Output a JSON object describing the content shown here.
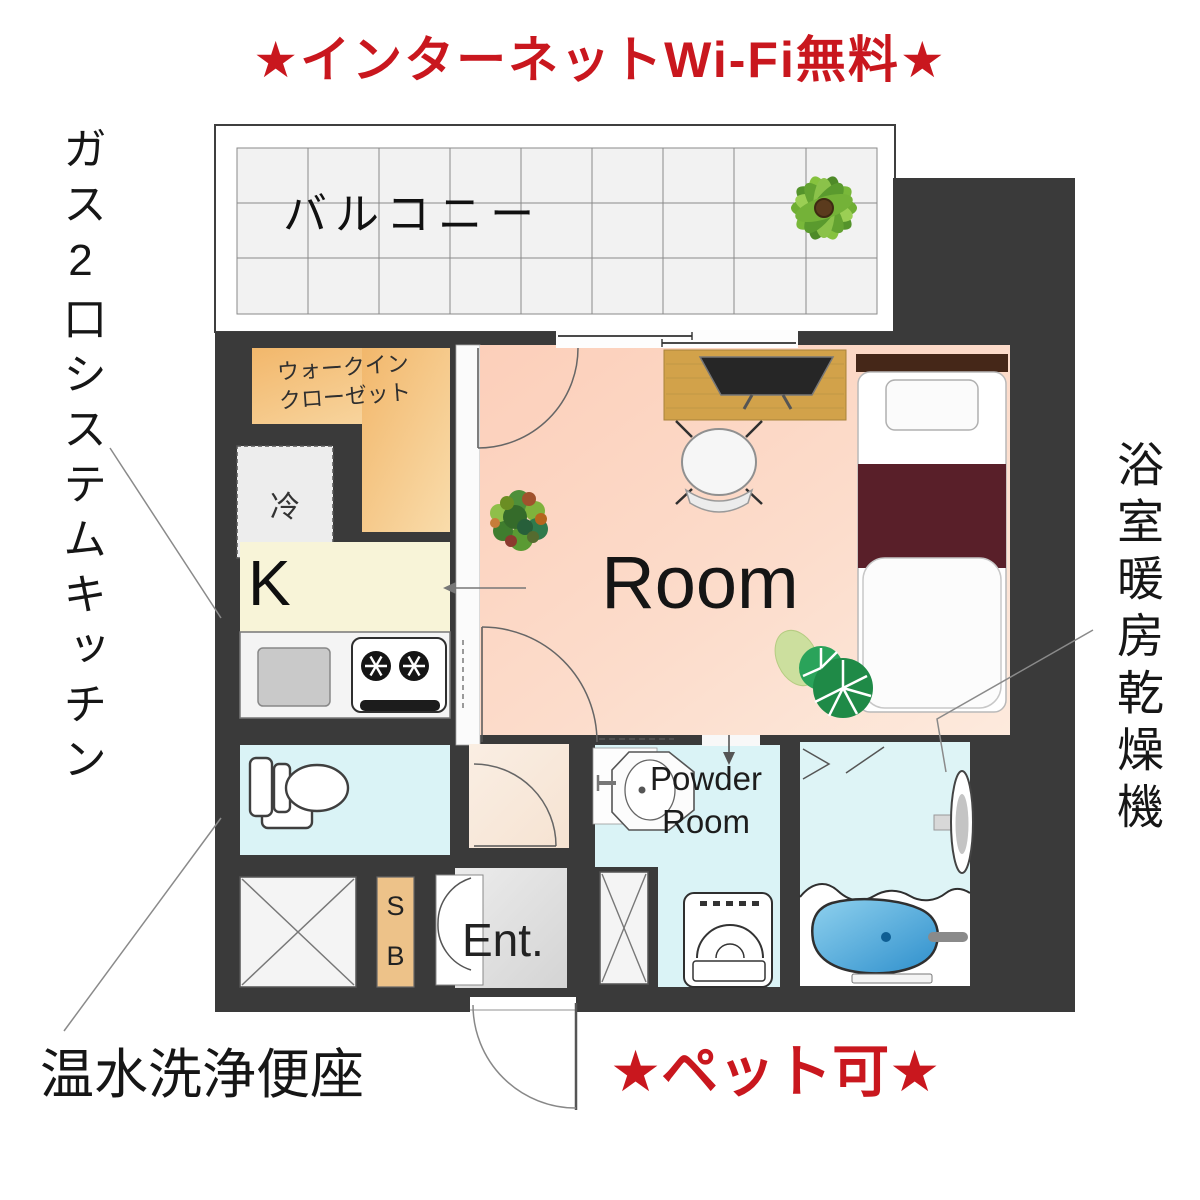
{
  "annotations": {
    "title": "★インターネットWi-Fi無料★",
    "left_note": "ガス2口システムキッチン",
    "right_note": "浴室暖房乾燥機",
    "bottom_left_note": "温水洗浄便座",
    "bottom_right_note": "★ペット可★"
  },
  "labels": {
    "balcony": "バルコニー",
    "closet_line1": "ウォークイン",
    "closet_line2": "クローゼット",
    "fridge": "冷",
    "kitchen": "K",
    "room": "Room",
    "powder_line1": "Powder",
    "powder_line2": "Room",
    "entrance": "Ent.",
    "shoebox_line1": "S",
    "shoebox_line2": "B"
  },
  "colors": {
    "accent_red": "#c9171e",
    "wall": "#3a3a3a",
    "room_floor": "#fcd5c2",
    "kitchen_floor": "#f8f4d8",
    "closet_floor": "#f3bc73",
    "wet_area_floor": "#daf3f6",
    "entrance_floor": "#e0e0e0",
    "shoebox": "#edc289",
    "bathtub": "#3f9fd8",
    "bed_blanket": "#591f29",
    "desk_wood": "#d2a24a",
    "balcony_tile": "#f2f2f2"
  }
}
